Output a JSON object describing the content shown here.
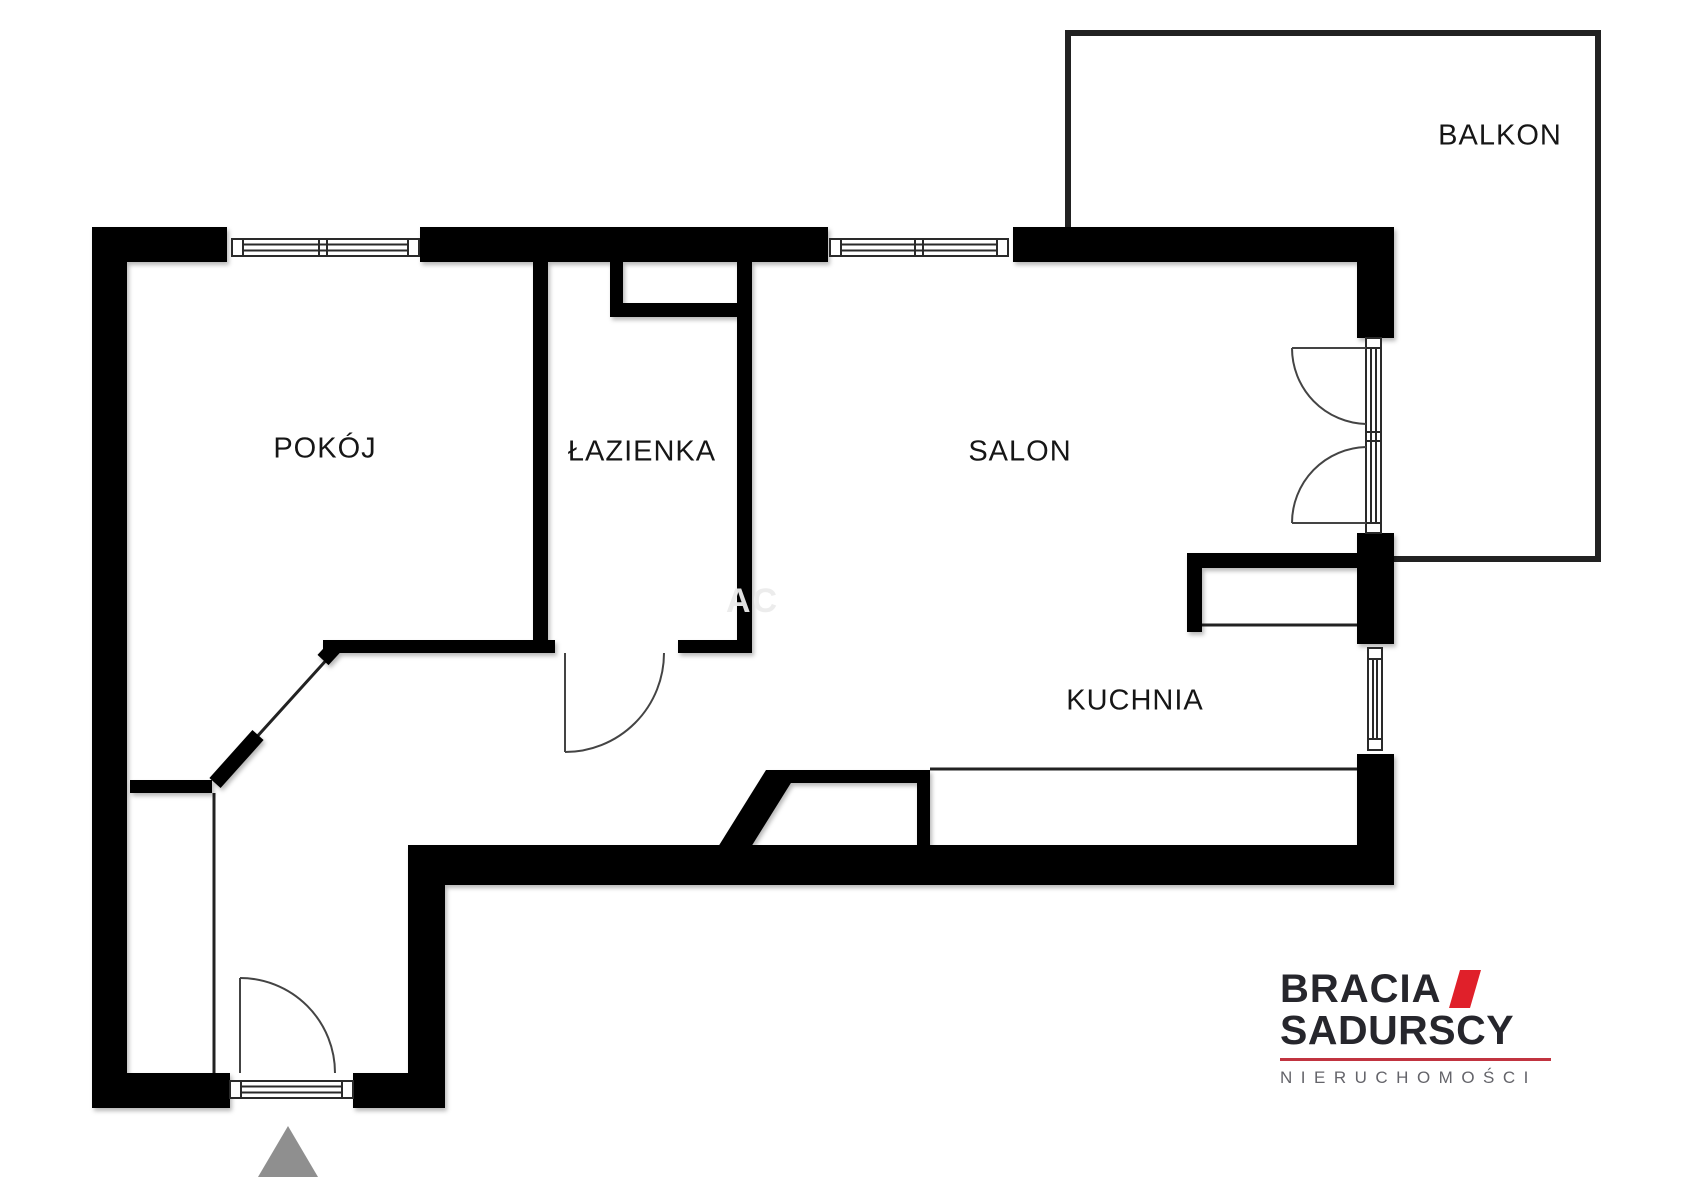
{
  "plan": {
    "rooms": [
      {
        "name": "pokoj",
        "label": "POKÓJ"
      },
      {
        "name": "lazienka",
        "label": "ŁAZIENKA"
      },
      {
        "name": "salon",
        "label": "SALON"
      },
      {
        "name": "kuchnia",
        "label": "KUCHNIA"
      },
      {
        "name": "balkon",
        "label": "BALKON"
      }
    ],
    "watermark": "AC",
    "colors": {
      "wall": "#000000",
      "door_line": "#444444",
      "thin_line": "#222222",
      "window_line": "#2a2a2a",
      "entrance_marker": "#8f8f8f"
    }
  },
  "logo": {
    "brand_top": "BRACIA",
    "brand_bottom": "SADURSCY",
    "tagline": "NIERUCHOMOŚCI",
    "colors": {
      "text": "#26262c",
      "accent": "#e0202a",
      "rule": "#c13440",
      "tagline_text": "#64646a"
    }
  }
}
